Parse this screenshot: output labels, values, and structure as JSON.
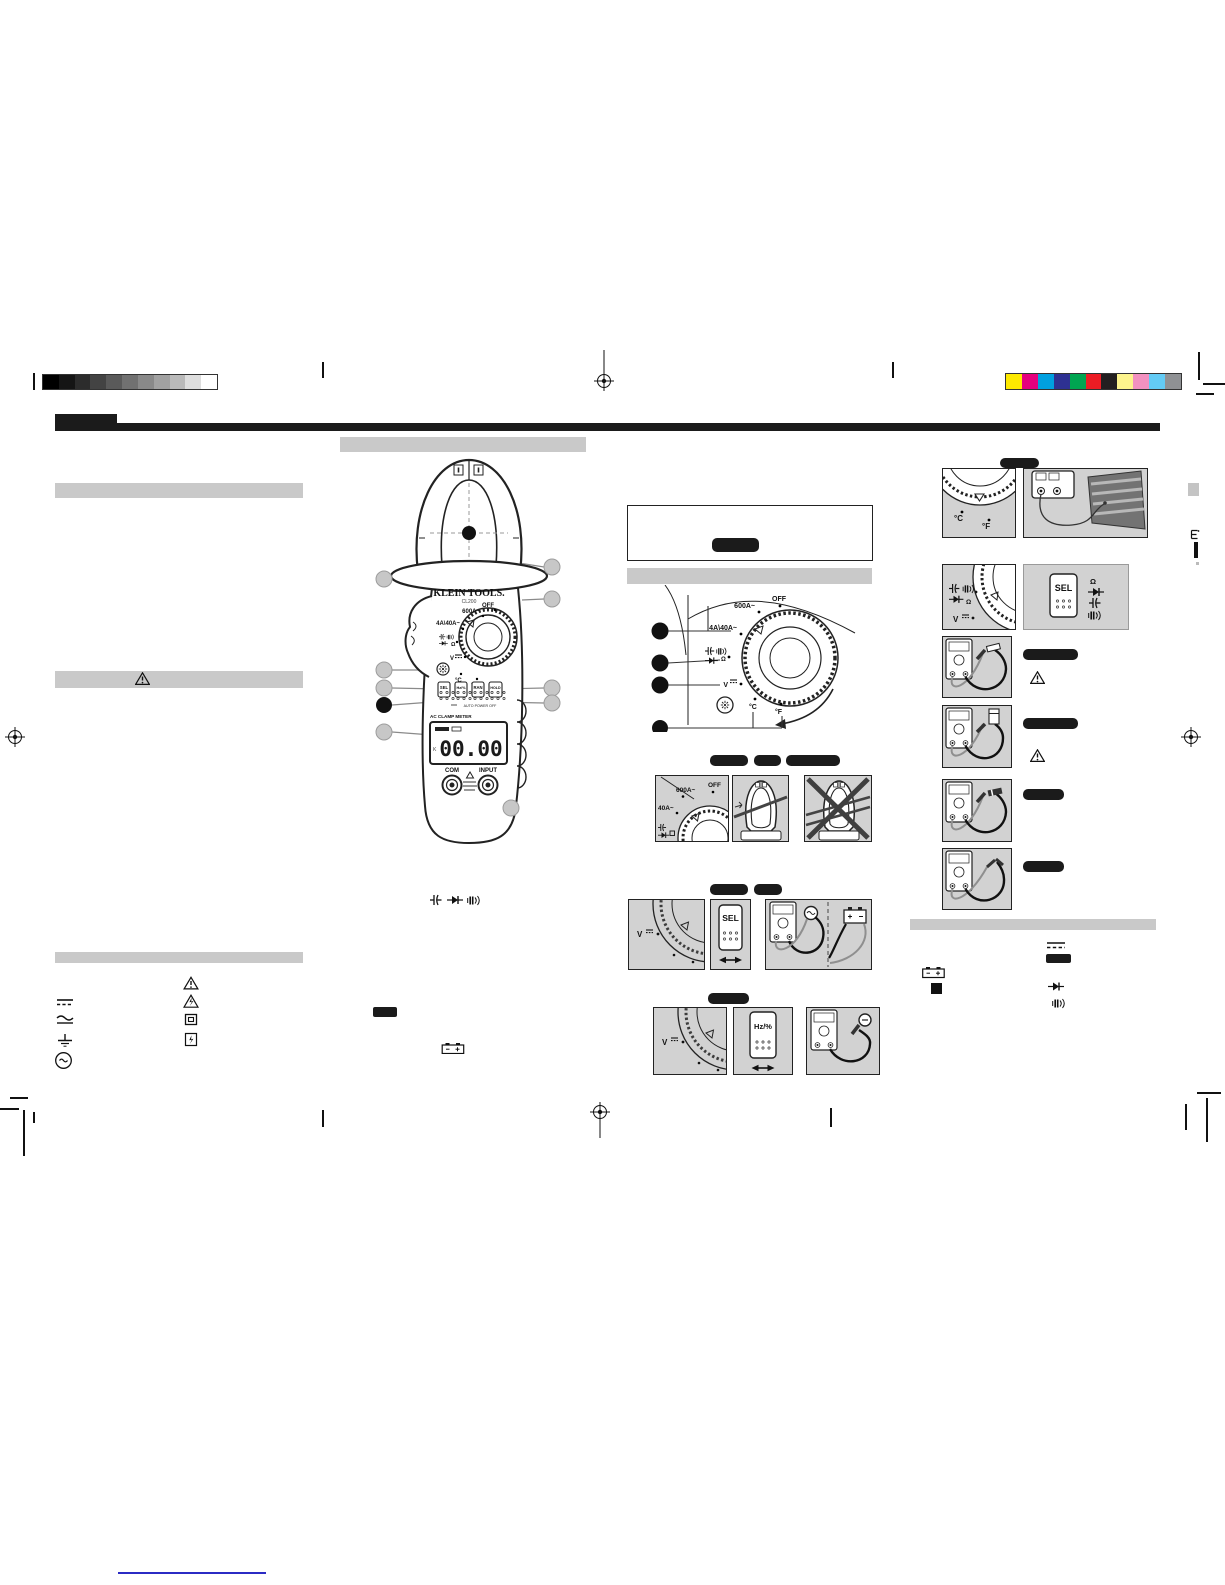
{
  "page": {
    "bg": "#ffffff"
  },
  "printer_marks": {
    "grayscale": [
      "#000000",
      "#151515",
      "#2c2c2c",
      "#434343",
      "#5a5a5a",
      "#717171",
      "#898989",
      "#a1a1a1",
      "#bababa",
      "#dedede",
      "#ffffff"
    ],
    "colors": [
      "#fde900",
      "#e5007d",
      "#00a0e0",
      "#2e3192",
      "#00a551",
      "#ec1c24",
      "#231f20",
      "#fdf48d",
      "#f291c0",
      "#63cbf5",
      "#8f9194"
    ]
  },
  "theme": {
    "section_bar": "#c9c9c9",
    "panel_bg": "#d2d2d2",
    "heading_bar": "#1b1b1b",
    "surface_dark": "#737373",
    "link_line": "#2b2bc4"
  },
  "meter": {
    "brand": "KLEIN TOOLS.",
    "model": "CL200",
    "display_title": "AC CLAMP METER",
    "auto_power_off": "AUTO POWER OFF",
    "lcd_value": "00.00",
    "lcd_flag": "K",
    "buttons": {
      "sel": "SEL",
      "hz_pct": "Hz/%",
      "range": "RAN",
      "hold": "HOLD"
    },
    "jacks": {
      "com": "COM",
      "input": "INPUT"
    },
    "dial": {
      "off": "OFF",
      "ac600": "600A~",
      "ac4_40": "4A\\40A~",
      "ohm": "Ω",
      "volts": "V",
      "deg_c": "°C",
      "deg_f": "°F"
    }
  },
  "dial_diagram": {
    "off": "OFF",
    "ac600": "600A~",
    "ac4_40": "4A\\40A~",
    "ohm": "Ω",
    "volts": "V",
    "deg_c": "°C",
    "deg_f": "°F"
  },
  "mid_panels": {
    "current_dial": {
      "ac600": "600A~",
      "off": "OFF",
      "ac40": "40A~"
    },
    "volt_label": "V",
    "sel_label": "SEL",
    "hz_label": "Hz/%"
  },
  "right_panels": {
    "temp_dial": {
      "deg_c": "°C",
      "deg_f": "°F"
    },
    "res_dial": {
      "ohm": "Ω",
      "volts": "V"
    },
    "sel_label": "SEL",
    "list_ohm": "Ω"
  }
}
